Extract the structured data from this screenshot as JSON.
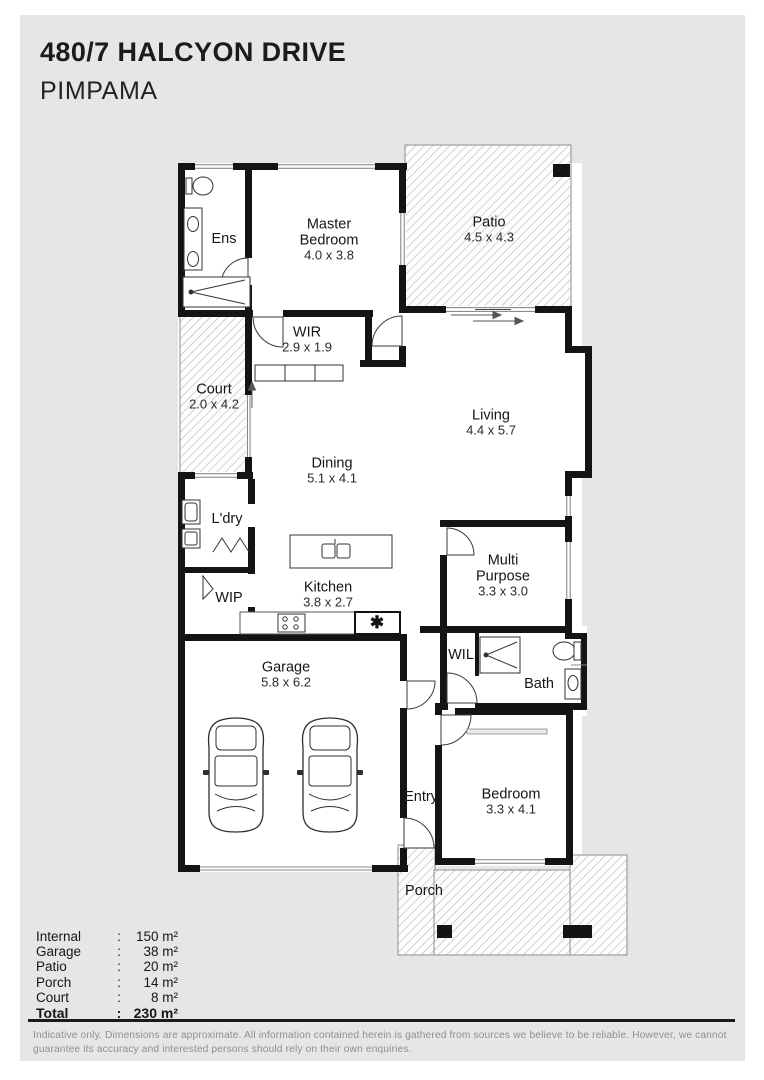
{
  "title": {
    "line1": "480/7 HALCYON DRIVE",
    "line2": "PIMPAMA"
  },
  "plan": {
    "rooms": {
      "ens": {
        "name": "Ens",
        "dims": ""
      },
      "master": {
        "name": "Master Bedroom",
        "dims": "4.0 x 3.8"
      },
      "patio": {
        "name": "Patio",
        "dims": "4.5 x 4.3"
      },
      "wir": {
        "name": "WIR",
        "dims": "2.9 x 1.9"
      },
      "court": {
        "name": "Court",
        "dims": "2.0 x 4.2"
      },
      "living": {
        "name": "Living",
        "dims": "4.4 x 5.7"
      },
      "dining": {
        "name": "Dining",
        "dims": "5.1 x 4.1"
      },
      "ldry": {
        "name": "L'dry",
        "dims": ""
      },
      "wip": {
        "name": "WIP",
        "dims": ""
      },
      "kitchen": {
        "name": "Kitchen",
        "dims": "3.8 x 2.7"
      },
      "multi": {
        "name": "Multi Purpose",
        "dims": "3.3 x 3.0"
      },
      "wil": {
        "name": "WIL",
        "dims": ""
      },
      "bath": {
        "name": "Bath",
        "dims": ""
      },
      "garage": {
        "name": "Garage",
        "dims": "5.8 x 6.2"
      },
      "entry": {
        "name": "Entry",
        "dims": ""
      },
      "bedroom": {
        "name": "Bedroom",
        "dims": "3.3 x 4.1"
      },
      "porch": {
        "name": "Porch",
        "dims": ""
      }
    },
    "pantry_symbol": "✱"
  },
  "legend": {
    "rows": [
      {
        "label": "Internal",
        "sep": ":",
        "value": "150 m²"
      },
      {
        "label": "Garage",
        "sep": ":",
        "value": "38 m²"
      },
      {
        "label": "Patio",
        "sep": ":",
        "value": "20 m²"
      },
      {
        "label": "Porch",
        "sep": ":",
        "value": "14 m²"
      },
      {
        "label": "Court",
        "sep": ":",
        "value": "8 m²"
      },
      {
        "label": "Total",
        "sep": ":",
        "value": "230 m²"
      }
    ]
  },
  "disclaimer": "Indicative only. Dimensions are approximate. All information contained herein is gathered from sources we believe to be reliable. However, we cannot guarantee its accuracy and interested persons should rely on their own enquiries."
}
